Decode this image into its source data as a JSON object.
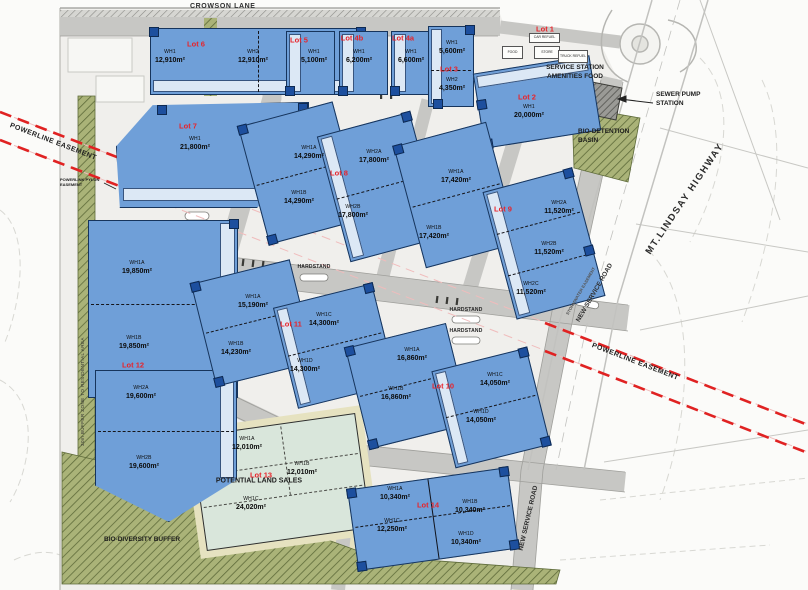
{
  "plan": {
    "roads": {
      "crowson_lane": "CROWSON LANE",
      "mt_lindsay_highway": "MT.LINDSAY HIGHWAY",
      "new_service_road_upper": "NEW SERVICE ROAD",
      "new_service_road_lower": "NEW SERVICE ROAD",
      "stormwater_easement": "STORMWATER EASEMENT"
    },
    "easements": {
      "powerline_left": "POWERLINE EASEMENT",
      "powerline_right": "POWERLINE EASEMENT",
      "powerlink_pylon": "POWERLINK PYLON EASEMENT"
    },
    "features": {
      "sewer_pump_station": "SEWER PUMP STATION",
      "bio_detention_basin": "BIO-DETENTION BASIN",
      "bio_diversity_buffer": "BIO-DIVERSITY BUFFER",
      "residential_buffer": "30m BUFFER ZONE TO RESIDENTIAL AREA",
      "hardstand": "HARDSTAND"
    },
    "colors": {
      "warehouse_fill": "#6f9fd8",
      "warehouse_border": "#16345c",
      "office_strip": "#dce8f5",
      "amenity_square": "#1d4f9e",
      "lot_label_red": "#e8232a",
      "powerline_red": "#e02222",
      "road_gray": "#c7c7c4",
      "buffer_green": "#a8b177",
      "land_sales_fill": "#d9e6db",
      "verge_khaki": "#e6e2c0"
    },
    "lots": [
      {
        "id": "6",
        "label": "Lot 6",
        "buildings": [
          {
            "code": "WH1",
            "area": "12,910m²"
          },
          {
            "code": "WH2",
            "area": "12,910m²"
          }
        ]
      },
      {
        "id": "5",
        "label": "Lot 5",
        "buildings": [
          {
            "code": "WH1",
            "area": "5,100m²"
          }
        ]
      },
      {
        "id": "4b",
        "label": "Lot 4b",
        "buildings": [
          {
            "code": "WH1",
            "area": "6,200m²"
          }
        ]
      },
      {
        "id": "4a",
        "label": "Lot 4a",
        "buildings": [
          {
            "code": "WH1",
            "area": "6,600m²"
          }
        ]
      },
      {
        "id": "3",
        "label": "Lot 3",
        "buildings": [
          {
            "code": "WH1",
            "area": "5,600m²"
          },
          {
            "code": "WH2",
            "area": "4,350m²"
          }
        ]
      },
      {
        "id": "1",
        "label": "Lot 1",
        "caption1": "SERVICE STATION",
        "caption2": "AMENITIES FOOD",
        "minis": [
          "CAR REFUEL",
          "FOOD",
          "STORE",
          "TRUCK REFUEL"
        ],
        "buildings": []
      },
      {
        "id": "2",
        "label": "Lot 2",
        "buildings": [
          {
            "code": "WH1",
            "area": "20,000m²"
          }
        ]
      },
      {
        "id": "7",
        "label": "Lot 7",
        "buildings": [
          {
            "code": "WH1",
            "area": "21,800m²"
          }
        ]
      },
      {
        "id": "8",
        "label": "Lot 8",
        "buildings": [
          {
            "code": "WH1A",
            "area": "14,290m²"
          },
          {
            "code": "WH1B",
            "area": "14,290m²"
          },
          {
            "code": "WH2A",
            "area": "17,800m²"
          },
          {
            "code": "WH2B",
            "area": "17,800m²"
          }
        ]
      },
      {
        "id": "9",
        "label": "Lot 9",
        "buildings": [
          {
            "code": "WH1A",
            "area": "17,420m²"
          },
          {
            "code": "WH1B",
            "area": "17,420m²"
          },
          {
            "code": "WH2A",
            "area": "11,520m²"
          },
          {
            "code": "WH2B",
            "area": "11,520m²"
          },
          {
            "code": "WH2C",
            "area": "11,520m²"
          }
        ]
      },
      {
        "id": "10",
        "label": "Lot 10",
        "buildings": [
          {
            "code": "WH1A",
            "area": "16,860m²"
          },
          {
            "code": "WH1B",
            "area": "16,860m²"
          },
          {
            "code": "WH1C",
            "area": "14,050m²"
          },
          {
            "code": "WH1D",
            "area": "14,050m²"
          }
        ]
      },
      {
        "id": "11",
        "label": "Lot 11",
        "buildings": [
          {
            "code": "WH1A",
            "area": "15,190m²"
          },
          {
            "code": "WH1B",
            "area": "14,230m²"
          },
          {
            "code": "WH1C",
            "area": "14,300m²"
          },
          {
            "code": "WH1D",
            "area": "14,300m²"
          }
        ]
      },
      {
        "id": "12",
        "label": "Lot 12",
        "buildings": [
          {
            "code": "WH1A",
            "area": "19,850m²"
          },
          {
            "code": "WH1B",
            "area": "19,850m²"
          },
          {
            "code": "WH2A",
            "area": "19,600m²"
          },
          {
            "code": "WH2B",
            "area": "19,600m²"
          }
        ]
      },
      {
        "id": "13",
        "label": "Lot 13",
        "note": "POTENTIAL LAND SALES",
        "buildings": [
          {
            "code": "WH1A",
            "area": "12,010m²"
          },
          {
            "code": "WH1B",
            "area": "12,010m²"
          },
          {
            "code": "WH1C",
            "area": "24,020m²"
          }
        ]
      },
      {
        "id": "14",
        "label": "Lot 14",
        "buildings": [
          {
            "code": "WH1A",
            "area": "10,340m²"
          },
          {
            "code": "WH1B",
            "area": "10,340m²"
          },
          {
            "code": "WH1C",
            "area": "12,250m²"
          },
          {
            "code": "WH1D",
            "area": "10,340m²"
          }
        ]
      }
    ]
  }
}
